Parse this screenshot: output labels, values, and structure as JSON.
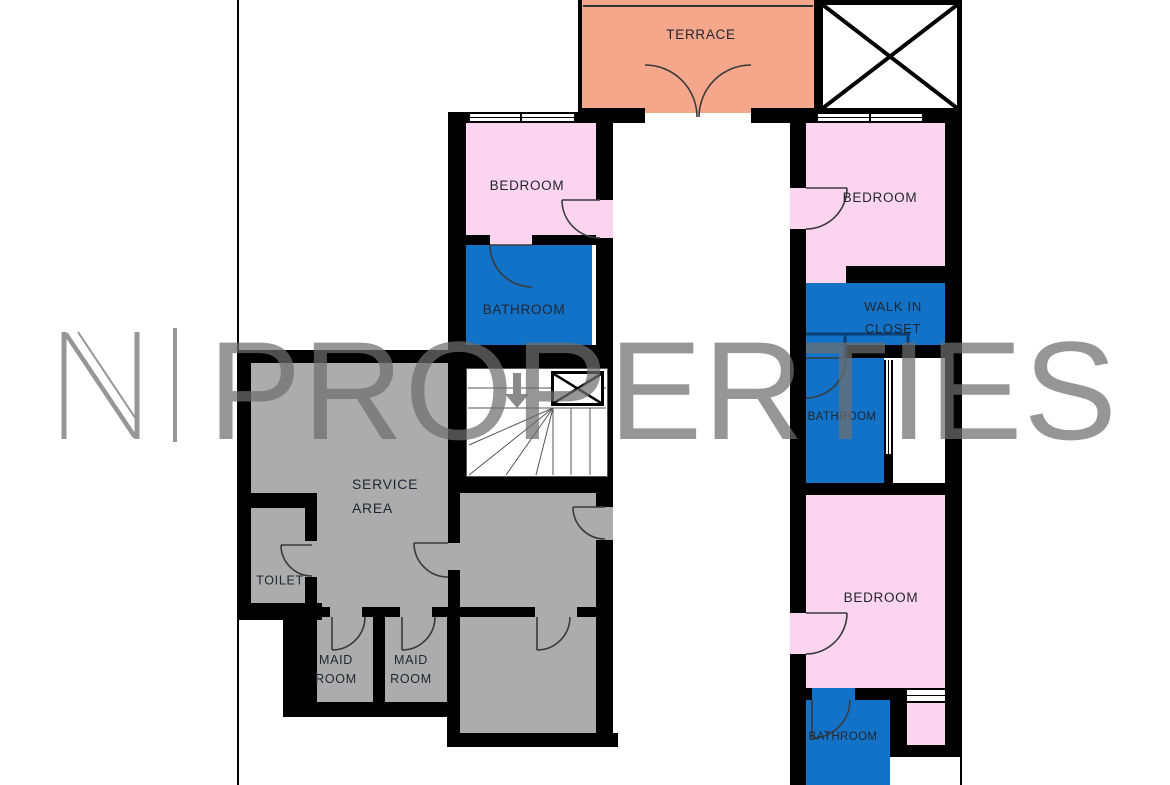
{
  "watermark": {
    "logo_letter": "N",
    "text": "PROPERTIES"
  },
  "rooms": {
    "terrace": {
      "label": "TERRACE"
    },
    "bedroom_left": {
      "label": "BEDROOM"
    },
    "bathroom_left": {
      "label": "BATHROOM"
    },
    "bedroom_right_top": {
      "label": "BEDROOM"
    },
    "walk_in_closet": {
      "line1": "WALK IN",
      "line2": "CLOSET"
    },
    "bathroom_right_top": {
      "label": "BATHROOM"
    },
    "bedroom_right_bottom": {
      "label": "BEDROOM"
    },
    "bathroom_right_bottom": {
      "label": "BATHROOM"
    },
    "service_area": {
      "line1": "SERVICE",
      "line2": "AREA"
    },
    "toilet": {
      "label": "TOILET"
    },
    "maid_room_1": {
      "line1": "MAID",
      "line2": "ROOM"
    },
    "maid_room_2": {
      "line1": "MAID",
      "line2": "ROOM"
    }
  },
  "colors": {
    "wall": "#000000",
    "terrace": "#F5A78B",
    "bedroom": "#FBD5F0",
    "wet_room": "#1272C8",
    "service": "#ACACAC",
    "watermark": "#6E6E6E",
    "label": "#23262E",
    "stair_arrow": "#8A8A8A",
    "closet_fixture": "#0A3F75",
    "door_line": "#3A3A3A"
  }
}
